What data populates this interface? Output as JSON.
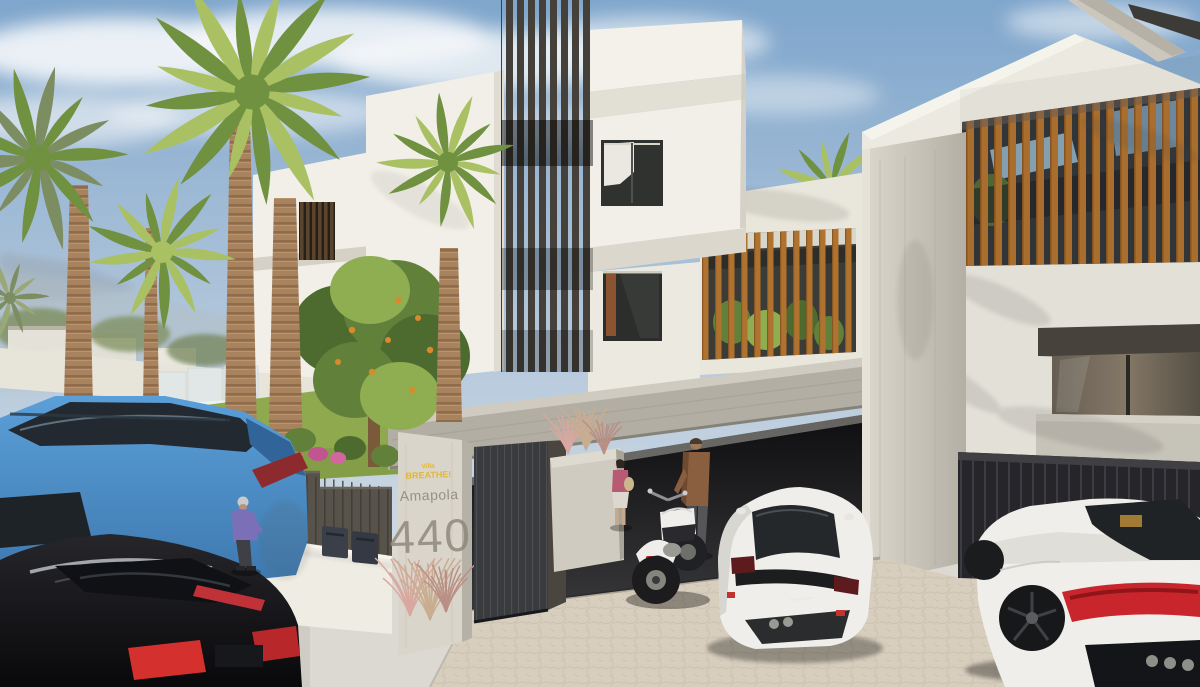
{
  "scene_description": "3D architectural rendering, street view of modern white villas with dark louver fins, wooden slat screens, palm garden, carports with cars and a motorcycle",
  "sign": {
    "logo_small": "Villa",
    "logo_main": "BREATHE!",
    "street_name": "Amapola",
    "house_number": "440"
  },
  "colors": {
    "sky_top": "#7fa6cc",
    "sky_mid": "#b9cbdd",
    "horizon": "#dfe5e9",
    "cloud": "#f5f7f9",
    "wall_white": "#f1efe7",
    "wall_warm": "#eceae0",
    "concrete": "#b2aea3",
    "concrete_light": "#cfcbc0",
    "pillar_light": "#d9d5ca",
    "louver_dark": "#45403a",
    "wood": "#b0722f",
    "door_dark": "#3a3b3f",
    "fence_dark": "#57524a",
    "lawn": "#8fa94f",
    "foliage_dark": "#4e6b2f",
    "foliage_mid": "#61803a",
    "foliage_light": "#8fae52",
    "palm_green": "#6f9140",
    "palm_light": "#a9c163",
    "palm_muted": "#7d8d62",
    "palm_muted2": "#9aa878",
    "trunk": "#a8835e",
    "flower_pink": "#d2679f",
    "flower_light": "#e083b8",
    "flower_deep": "#c05590",
    "fruit_orange": "#d98a2b",
    "grass_pink": "#d8a8a0",
    "grass_tan": "#c9ad90",
    "grass_mauve": "#b98f86",
    "sign_yellow": "#e3b733",
    "sign_gray": "#8e897c",
    "car_blue": "#4f93cf",
    "car_blue_dark": "#3c77ad",
    "car_black": "#141417",
    "car_white": "#efeeea",
    "taillight": "#c8262c",
    "ground": "#dcd9d2",
    "street": "#cdcac3",
    "cobble": "#d8cebe",
    "cobble_line": "#c3b7a4",
    "garage_dark": "#1b1a1d",
    "glass_dark": "#2e302f",
    "carport_dark": "#26262a"
  }
}
